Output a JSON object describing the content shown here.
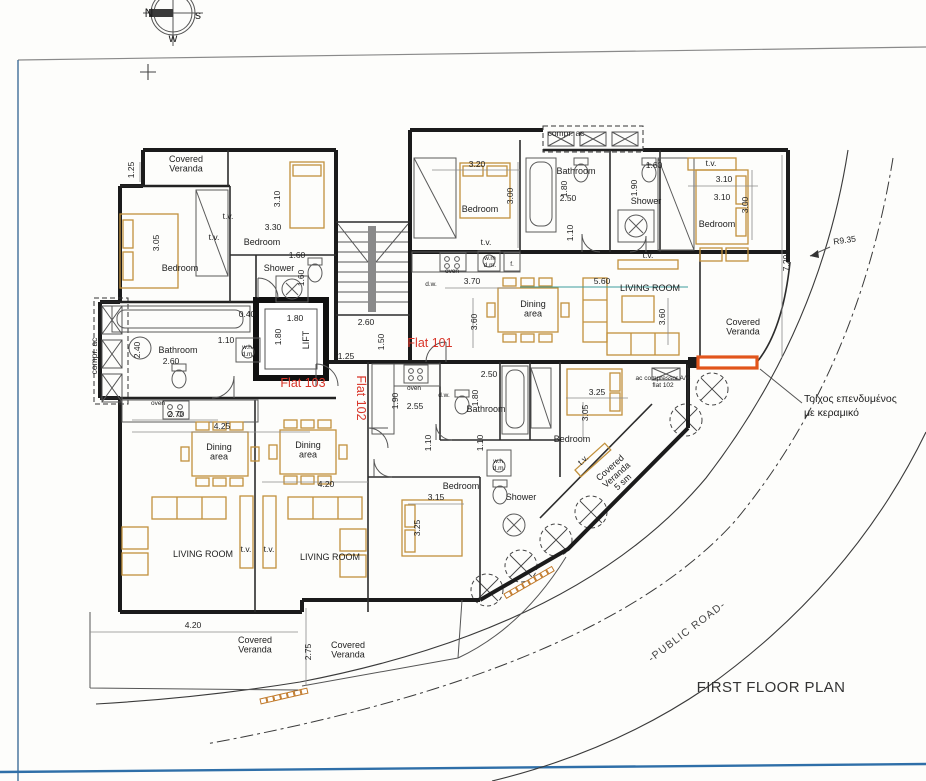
{
  "page": {
    "title": "FIRST FLOOR PLAN"
  },
  "compass": {
    "n": "N",
    "s": "s",
    "w": "w"
  },
  "site": {
    "road_label": "-PUBLIC ROAD-",
    "radius_label": "R9.35",
    "wall_note_line1": "Τοίχος επενδυμένος",
    "wall_note_line2": "με κεραμικό"
  },
  "flats": [
    {
      "label": "Flat 101"
    },
    {
      "label": "Flat 102"
    },
    {
      "label": "Flat 103"
    }
  ],
  "colors": {
    "flat_label": "#d8362a",
    "furniture": "#c2913c",
    "highlight_wall": "#e2551c",
    "border_blue": "#3d76ab",
    "dim_teal": "#3d9d9d"
  },
  "labels": [
    {
      "text": "1.25",
      "x": 134,
      "y": 170,
      "rot": -90,
      "cls": "dim",
      "name": "dim-1-25"
    },
    {
      "text": "Covered\nVeranda",
      "x": 186,
      "y": 162,
      "cls": "room",
      "name": "room-covered-veranda-nw"
    },
    {
      "text": "3.05",
      "x": 159,
      "y": 243,
      "rot": -90,
      "cls": "dim",
      "name": "dim-3-05"
    },
    {
      "text": "Bedroom",
      "x": 180,
      "y": 271,
      "cls": "room",
      "name": "room-bedroom-nw"
    },
    {
      "text": "t.v.",
      "x": 228,
      "y": 219,
      "cls": "dim",
      "name": "tv-label"
    },
    {
      "text": "t.v.",
      "x": 214,
      "y": 240,
      "cls": "dim",
      "name": "tv-label"
    },
    {
      "text": "3.10",
      "x": 280,
      "y": 199,
      "rot": -90,
      "cls": "dim",
      "name": "dim-3-10"
    },
    {
      "text": "3.30",
      "x": 273,
      "y": 230,
      "cls": "dim",
      "name": "dim-3-30"
    },
    {
      "text": "Bedroom",
      "x": 262,
      "y": 245,
      "cls": "room",
      "name": "room-bedroom-n2"
    },
    {
      "text": "1.60",
      "x": 297,
      "y": 258,
      "cls": "dim",
      "name": "dim-1-60"
    },
    {
      "text": "Shower",
      "x": 279,
      "y": 271,
      "cls": "room",
      "name": "room-shower-103"
    },
    {
      "text": "1.60",
      "x": 304,
      "y": 278,
      "rot": -90,
      "cls": "dim",
      "name": "dim-1-60b"
    },
    {
      "text": "0.40",
      "x": 247,
      "y": 317,
      "cls": "dim",
      "name": "dim-0-40"
    },
    {
      "text": "1.10",
      "x": 226,
      "y": 343,
      "cls": "dim",
      "name": "dim-1-10"
    },
    {
      "text": "2.40",
      "x": 140,
      "y": 350,
      "rot": -90,
      "cls": "dim",
      "name": "dim-2-40"
    },
    {
      "text": "Bathroom",
      "x": 178,
      "y": 353,
      "cls": "room",
      "name": "room-bathroom-103"
    },
    {
      "text": "2.60",
      "x": 171,
      "y": 364,
      "cls": "dim",
      "name": "dim-2-60"
    },
    {
      "text": "w.h\nd.m",
      "x": 247,
      "y": 349,
      "cls": "tiny",
      "name": "appliance-wh-dm"
    },
    {
      "text": "compr. ac",
      "x": 97,
      "y": 356,
      "rot": -90,
      "cls": "dim",
      "name": "compr-ac-left"
    },
    {
      "text": "oven",
      "x": 158,
      "y": 405,
      "cls": "tiny",
      "name": "appliance-oven-103"
    },
    {
      "text": "2.70",
      "x": 176,
      "y": 417,
      "cls": "dim",
      "name": "dim-2-70"
    },
    {
      "text": "4.25",
      "x": 222,
      "y": 429,
      "cls": "dim",
      "name": "dim-4-25"
    },
    {
      "text": "Dining\narea",
      "x": 219,
      "y": 450,
      "cls": "room",
      "name": "room-dining-103"
    },
    {
      "text": "Dining\narea",
      "x": 308,
      "y": 448,
      "cls": "room",
      "name": "room-dining-102"
    },
    {
      "text": "4.20",
      "x": 326,
      "y": 487,
      "cls": "dim",
      "name": "dim-4-20"
    },
    {
      "text": "LIVING ROOM",
      "x": 203,
      "y": 557,
      "cls": "room",
      "name": "room-living-103"
    },
    {
      "text": "LIVING ROOM",
      "x": 330,
      "y": 560,
      "cls": "room",
      "name": "room-living-102"
    },
    {
      "text": "t.v.",
      "x": 246,
      "y": 552,
      "cls": "dim",
      "name": "tv-label"
    },
    {
      "text": "t.v.",
      "x": 269,
      "y": 552,
      "cls": "dim",
      "name": "tv-label"
    },
    {
      "text": "4.20",
      "x": 193,
      "y": 628,
      "cls": "dim",
      "name": "dim-4-20-veranda"
    },
    {
      "text": "Covered\nVeranda",
      "x": 255,
      "y": 643,
      "cls": "room",
      "name": "room-covered-veranda-sw"
    },
    {
      "text": "2.75",
      "x": 311,
      "y": 652,
      "rot": -90,
      "cls": "dim",
      "name": "dim-2-75"
    },
    {
      "text": "Covered\nVeranda",
      "x": 348,
      "y": 648,
      "cls": "room",
      "name": "room-covered-veranda-s"
    },
    {
      "text": "1.80",
      "x": 295,
      "y": 321,
      "cls": "dim",
      "name": "dim-lift-w"
    },
    {
      "text": "1.80",
      "x": 281,
      "y": 337,
      "rot": -90,
      "cls": "dim",
      "name": "dim-lift-h"
    },
    {
      "text": "LIFT",
      "x": 309,
      "y": 340,
      "rot": -90,
      "cls": "room",
      "name": "room-lift"
    },
    {
      "text": "2.60",
      "x": 366,
      "y": 325,
      "cls": "dim",
      "name": "dim-2-60-hall"
    },
    {
      "text": "1.50",
      "x": 384,
      "y": 342,
      "rot": -90,
      "cls": "dim",
      "name": "dim-1-50"
    },
    {
      "text": "1.25",
      "x": 346,
      "y": 359,
      "cls": "dim",
      "name": "dim-1-25-hall"
    },
    {
      "text": "compr. ac",
      "x": 566,
      "y": 136,
      "cls": "dim",
      "name": "compr-ac-top"
    },
    {
      "text": "3.20",
      "x": 477,
      "y": 167,
      "cls": "dim",
      "name": "dim-3-20"
    },
    {
      "text": "Bedroom",
      "x": 480,
      "y": 212,
      "cls": "room",
      "name": "room-bedroom-101a"
    },
    {
      "text": "3.00",
      "x": 513,
      "y": 196,
      "rot": -90,
      "cls": "dim",
      "name": "dim-3-00"
    },
    {
      "text": "t.v.",
      "x": 486,
      "y": 245,
      "cls": "dim",
      "name": "tv-label"
    },
    {
      "text": "oven",
      "x": 452,
      "y": 273,
      "cls": "tiny",
      "name": "appliance-oven-101"
    },
    {
      "text": "d.w.",
      "x": 431,
      "y": 286,
      "cls": "tiny",
      "name": "appliance-dw-101"
    },
    {
      "text": "3.70",
      "x": 472,
      "y": 284,
      "cls": "dim",
      "name": "dim-3-70"
    },
    {
      "text": "w.m\nd.m.",
      "x": 490,
      "y": 260,
      "cls": "tiny",
      "name": "appliance-wm-dm"
    },
    {
      "text": "f.",
      "x": 512,
      "y": 266,
      "cls": "tiny",
      "name": "appliance-fridge"
    },
    {
      "text": "3.60",
      "x": 477,
      "y": 322,
      "rot": -90,
      "cls": "dim",
      "name": "dim-3-60w"
    },
    {
      "text": "Bathroom",
      "x": 576,
      "y": 174,
      "cls": "room",
      "name": "room-bathroom-101"
    },
    {
      "text": "1.80",
      "x": 567,
      "y": 189,
      "rot": -90,
      "cls": "dim",
      "name": "dim-1-80-bath"
    },
    {
      "text": "2.50",
      "x": 568,
      "y": 201,
      "cls": "dim",
      "name": "dim-2-50-bath"
    },
    {
      "text": "1.10",
      "x": 573,
      "y": 233,
      "rot": -90,
      "cls": "dim",
      "name": "dim-1-10-bath"
    },
    {
      "text": "1.60",
      "x": 654,
      "y": 168,
      "cls": "dim",
      "name": "dim-1-60-shower"
    },
    {
      "text": "1.90",
      "x": 637,
      "y": 188,
      "rot": -90,
      "cls": "dim",
      "name": "dim-1-90-shower"
    },
    {
      "text": "Shower",
      "x": 646,
      "y": 204,
      "cls": "room",
      "name": "room-shower-101"
    },
    {
      "text": "t.v.",
      "x": 648,
      "y": 258,
      "cls": "dim",
      "name": "tv-label"
    },
    {
      "text": "t.v.",
      "x": 711,
      "y": 166,
      "cls": "dim",
      "name": "tv-label"
    },
    {
      "text": "3.10",
      "x": 724,
      "y": 182,
      "cls": "dim",
      "name": "dim-3-10-ne"
    },
    {
      "text": "3.10",
      "x": 722,
      "y": 200,
      "cls": "dim",
      "name": "dim-3-10-bed"
    },
    {
      "text": "3.00",
      "x": 748,
      "y": 205,
      "rot": -90,
      "cls": "dim",
      "name": "dim-3-00-ne"
    },
    {
      "text": "Bedroom",
      "x": 717,
      "y": 227,
      "cls": "room",
      "name": "room-bedroom-101b"
    },
    {
      "text": "7.20",
      "x": 789,
      "y": 263,
      "rot": -90,
      "cls": "dim",
      "name": "dim-7-20"
    },
    {
      "text": "5.60",
      "x": 602,
      "y": 284,
      "cls": "dim",
      "name": "dim-5-60"
    },
    {
      "text": "LIVING ROOM",
      "x": 650,
      "y": 291,
      "cls": "room",
      "name": "room-living-101"
    },
    {
      "text": "Dining\narea",
      "x": 533,
      "y": 307,
      "cls": "room",
      "name": "room-dining-101"
    },
    {
      "text": "3.60",
      "x": 665,
      "y": 317,
      "rot": -90,
      "cls": "dim",
      "name": "dim-3-60e"
    },
    {
      "text": "Covered\nVeranda",
      "x": 743,
      "y": 325,
      "cls": "room",
      "name": "room-covered-veranda-e"
    },
    {
      "text": "ac compressor A/C\nflat 102",
      "x": 663,
      "y": 380,
      "cls": "tiny",
      "name": "ac-compressor-note"
    },
    {
      "text": "2.50",
      "x": 489,
      "y": 377,
      "cls": "dim",
      "name": "dim-2-50-102"
    },
    {
      "text": "oven",
      "x": 414,
      "y": 390,
      "cls": "tiny",
      "name": "appliance-oven-102"
    },
    {
      "text": "1.90",
      "x": 398,
      "y": 401,
      "rot": -90,
      "cls": "dim",
      "name": "dim-1-90-102"
    },
    {
      "text": "2.55",
      "x": 415,
      "y": 409,
      "cls": "dim",
      "name": "dim-2-55"
    },
    {
      "text": "d.w.",
      "x": 444,
      "y": 397,
      "cls": "tiny",
      "name": "appliance-dw-102"
    },
    {
      "text": "1.80",
      "x": 478,
      "y": 398,
      "rot": -90,
      "cls": "dim",
      "name": "dim-1-80-102"
    },
    {
      "text": "Bathroom",
      "x": 486,
      "y": 412,
      "cls": "room",
      "name": "room-bathroom-102"
    },
    {
      "text": "1.10",
      "x": 431,
      "y": 443,
      "rot": -90,
      "cls": "dim",
      "name": "dim-1-10a-102"
    },
    {
      "text": "1.10",
      "x": 483,
      "y": 443,
      "rot": -90,
      "cls": "dim",
      "name": "dim-1-10b-102"
    },
    {
      "text": "3.25",
      "x": 597,
      "y": 395,
      "cls": "dim",
      "name": "dim-3-25-bed"
    },
    {
      "text": "3.05",
      "x": 588,
      "y": 413,
      "rot": -90,
      "cls": "dim",
      "name": "dim-3-05-bed"
    },
    {
      "text": "Bedroom",
      "x": 572,
      "y": 442,
      "cls": "room",
      "name": "room-bedroom-102a"
    },
    {
      "text": "w.h.\nd.m.",
      "x": 499,
      "y": 463,
      "cls": "tiny",
      "name": "appliance-wh-dm-102"
    },
    {
      "text": "Bedroom",
      "x": 461,
      "y": 489,
      "cls": "room",
      "name": "room-bedroom-102b"
    },
    {
      "text": "3.15",
      "x": 436,
      "y": 500,
      "cls": "dim",
      "name": "dim-3-15"
    },
    {
      "text": "Shower",
      "x": 521,
      "y": 500,
      "cls": "room",
      "name": "room-shower-102"
    },
    {
      "text": "3.25",
      "x": 420,
      "y": 528,
      "rot": -90,
      "cls": "dim",
      "name": "dim-3-25-small"
    },
    {
      "text": "Covered\nVeranda\n5 sm",
      "x": 612,
      "y": 470,
      "rot": -42,
      "cls": "room",
      "name": "room-covered-veranda-diag"
    },
    {
      "text": "t.v.",
      "x": 585,
      "y": 462,
      "rot": -42,
      "cls": "dim",
      "name": "tv-label-diag"
    }
  ]
}
